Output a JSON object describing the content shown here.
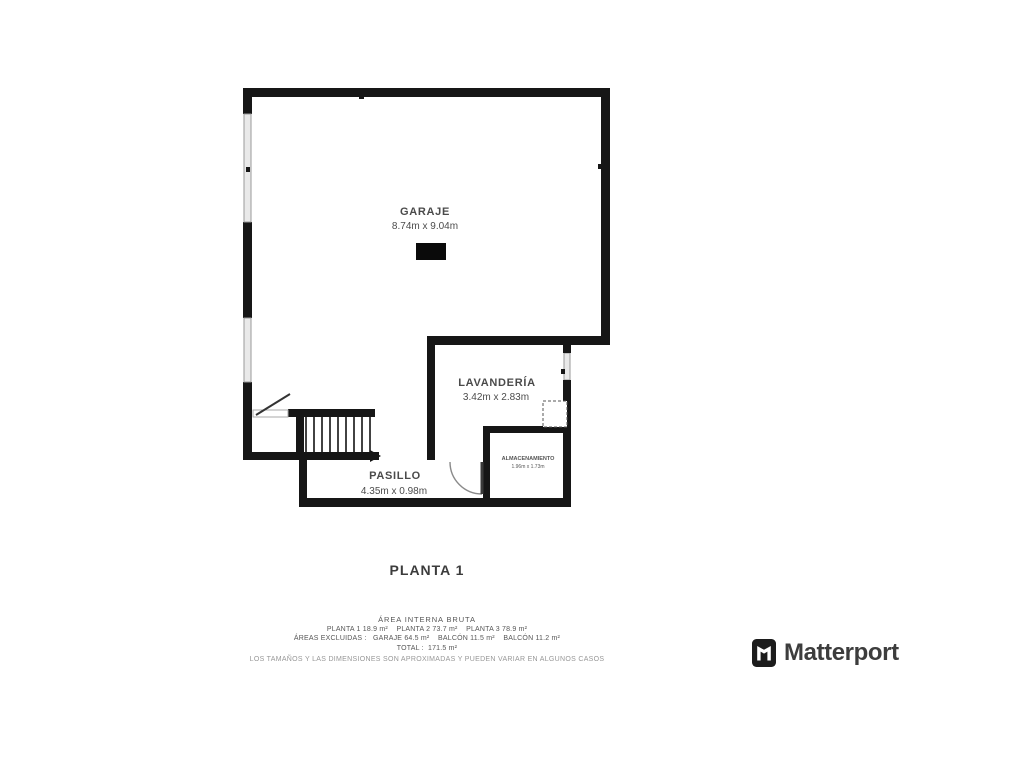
{
  "plan": {
    "floor_title": "PLANTA 1",
    "rooms": [
      {
        "name": "GARAJE",
        "dims": "8.74m x 9.04m"
      },
      {
        "name": "LAVANDERÍA",
        "dims": "3.42m x 2.83m"
      },
      {
        "name": "ALMACENAMIENTO",
        "dims": "1.96m x 1.73m"
      },
      {
        "name": "PASILLO",
        "dims": "4.35m x 0.98m"
      }
    ]
  },
  "footer": {
    "area_header": "ÁREA INTERNA BRUTA",
    "line_plantas": "PLANTA 1 18.9 m²    PLANTA 2 73.7 m²    PLANTA 3 78.9 m²",
    "line_excluidas": "ÁREAS EXCLUIDAS :   GARAJE 64.5 m²    BALCÓN 11.5 m²    BALCÓN 11.2 m²",
    "line_total": "TOTAL :  171.5 m²",
    "disclaimer": "LOS TAMAÑOS Y LAS DIMENSIONES SON APROXIMADAS Y PUEDEN VARIAR EN ALGUNOS CASOS"
  },
  "branding": {
    "logo_text": "Matterport",
    "logo_icon": "matterport-icon"
  },
  "colors": {
    "wall": "#161616",
    "window_stroke": "#9a9a9a",
    "window_fill": "#e9e9e9",
    "label": "#4a4a4a",
    "footer_text": "#565656",
    "disclaimer": "#979797",
    "logo_text": "#3d3d3d"
  }
}
